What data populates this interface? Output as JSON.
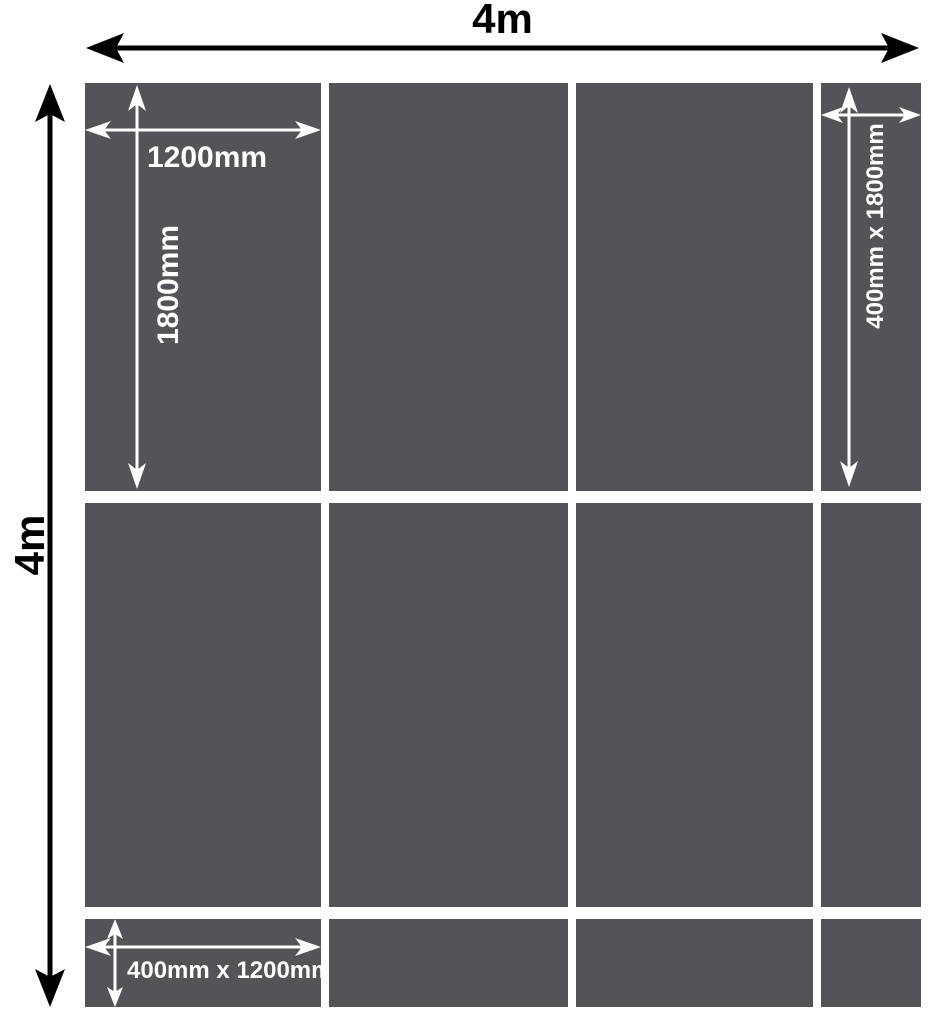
{
  "diagram": {
    "overall_width_label": "4m",
    "overall_height_label": "4m",
    "panel_fill": "#565358",
    "arrow_color_outer": "#000000",
    "arrow_color_inner": "#ffffff",
    "annotations": {
      "large_panel_width": "1200mm",
      "large_panel_height": "1800mm",
      "narrow_panel_size": "400mm x 1800mm",
      "short_panel_size": "400mm x 1200mm"
    },
    "grid": {
      "columns": [
        "1200mm",
        "1200mm",
        "1200mm",
        "400mm"
      ],
      "rows": [
        "1800mm",
        "1800mm",
        "400mm"
      ]
    }
  }
}
